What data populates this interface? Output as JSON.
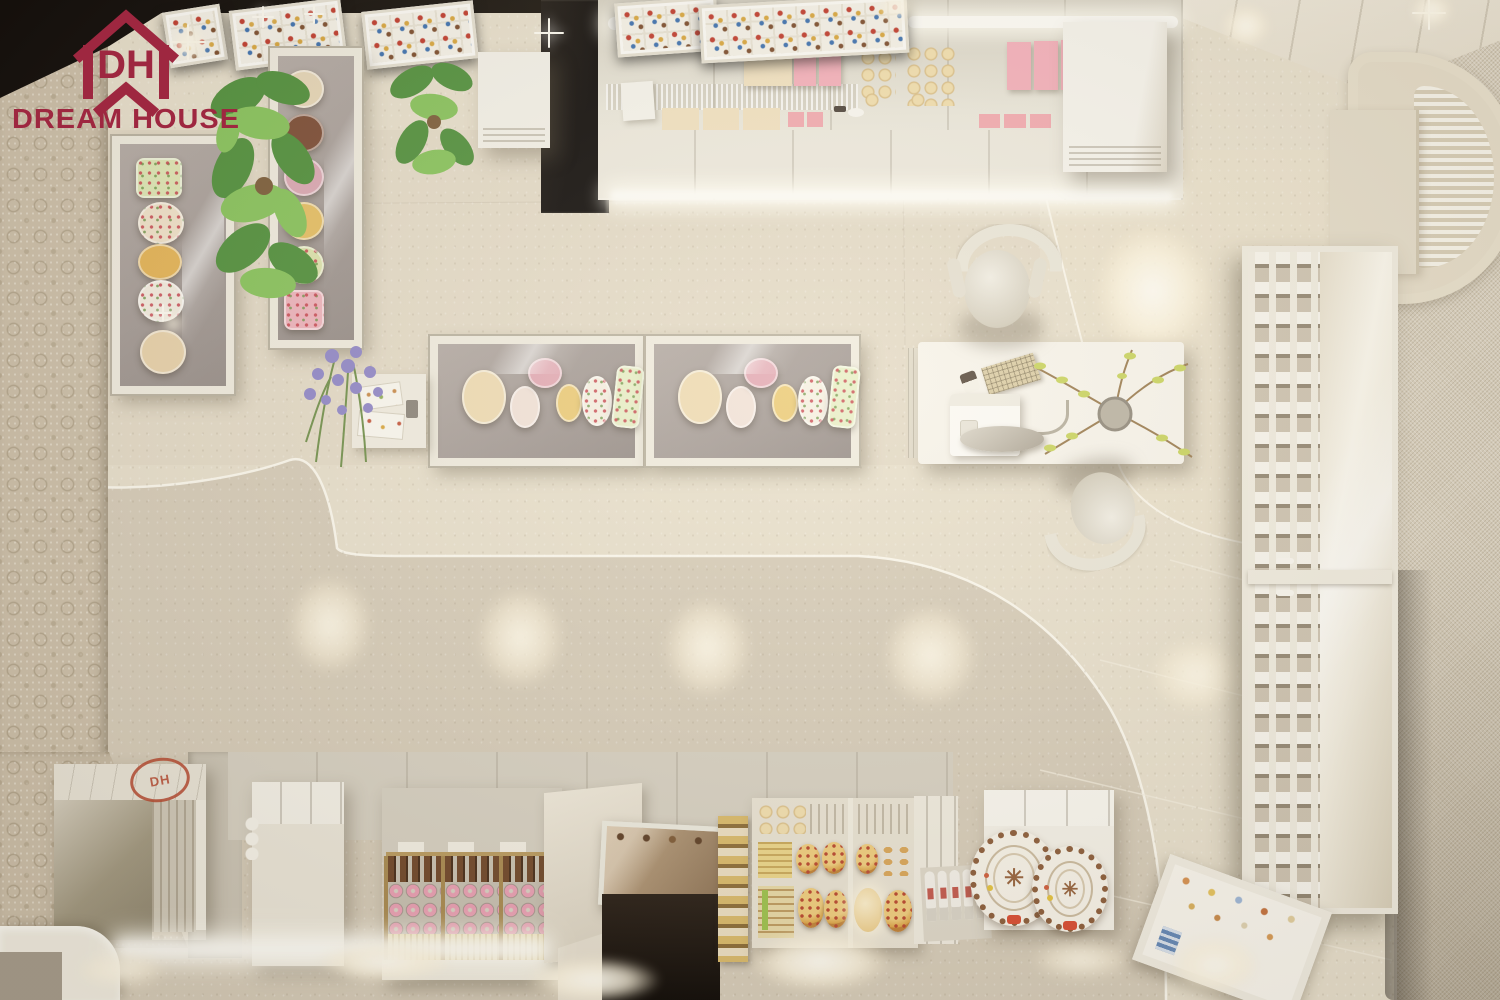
{
  "page": {
    "description": "Top-down 3D interior render of a pastry / bakery shop in warm beige tones with display cases, cashier desk and product shelves"
  },
  "brand": {
    "logo_text": "DREAM HOUSE",
    "logo_monogram": "DH",
    "logo_color": "#9e2740",
    "stamp_color": "#b5452c"
  },
  "decorations": {
    "snowflake_glyph": "✳"
  },
  "palette": {
    "ceiling_dark": "#0b0705",
    "wallpaper_base": "#cdc0aa",
    "wallpaper_motif": "#a99b80",
    "floor_dark": "#d6ccb9",
    "floor_light": "#e8e0cd",
    "walkway_highlight": "#fffdf4",
    "counter_face": "#ebe8dc",
    "case_frame": "#f0ece0",
    "case_interior": "#a39a96",
    "display_gold": "#b99a5e",
    "glow_warm": "#fff3dc",
    "right_wall": "#d8cfbc"
  },
  "scene": {
    "top_shelf_goods": {
      "cream_box_color": "#f2e2c1",
      "pink_box_color": "#f5afbb",
      "pink_pack_color": "#f3a9b0",
      "bun_color": "#eed7a6"
    },
    "plants": {
      "monstera_green_dark": "#4e8f3a",
      "monstera_green_light": "#86c35a",
      "lavender_purple": "#8f86c9",
      "lavender_stem": "#6f8f4a",
      "twig_branch": "#9a7b4f",
      "twig_leaf": "#c9d45e"
    },
    "left_case_cakes": [
      {
        "name": "floral-box-cake",
        "color": "#dfe8b6"
      },
      {
        "name": "cream-floral-cake",
        "color": "#f1e3cb"
      },
      {
        "name": "caramel-cake",
        "color": "#e5b455"
      },
      {
        "name": "white-floral-cake",
        "color": "#f4eee2"
      },
      {
        "name": "plain-sponge-cake",
        "color": "#e8d2ab"
      }
    ],
    "tall_case_cakes": [
      {
        "name": "sponge-cake",
        "color": "#e7d7b8"
      },
      {
        "name": "chocolate-cake",
        "color": "#7a4a33"
      },
      {
        "name": "berry-cake",
        "color": "#dba8b4"
      },
      {
        "name": "mango-cake",
        "color": "#e6bf63"
      },
      {
        "name": "pistachio-floral-cake",
        "color": "#dde4ad"
      },
      {
        "name": "rose-box-cake",
        "color": "#eeb3bd"
      }
    ],
    "island_case_cakes": [
      {
        "name": "vanilla-round",
        "color": "#efdcb4"
      },
      {
        "name": "strawberry-cream-round",
        "color": "#f2e3da"
      },
      {
        "name": "raspberry-round",
        "color": "#e3aab6"
      },
      {
        "name": "lemon-round",
        "color": "#eccc79"
      },
      {
        "name": "decorated-white-round",
        "color": "#f6f1e4"
      },
      {
        "name": "floral-sheet-cake",
        "color": "#e9f0c9"
      }
    ],
    "bottom_displays": {
      "eclair_color": "#6e4527",
      "donut_color": "#ea9fb4",
      "wafer_color": "#efe0ae",
      "pizza_crust": "#dca344",
      "pizza_topping": "#b8432a",
      "bread_color": "#e4b875",
      "bottle_color": "#f4f1ea",
      "cookie_plate_rim": "#8a5a37"
    },
    "counts": {
      "menu_lightboxes": 5,
      "island_display_cases": 2,
      "desk_chairs": 2,
      "plate_cabinet_sections": 2,
      "decorated_cookie_cakes": 2
    }
  }
}
